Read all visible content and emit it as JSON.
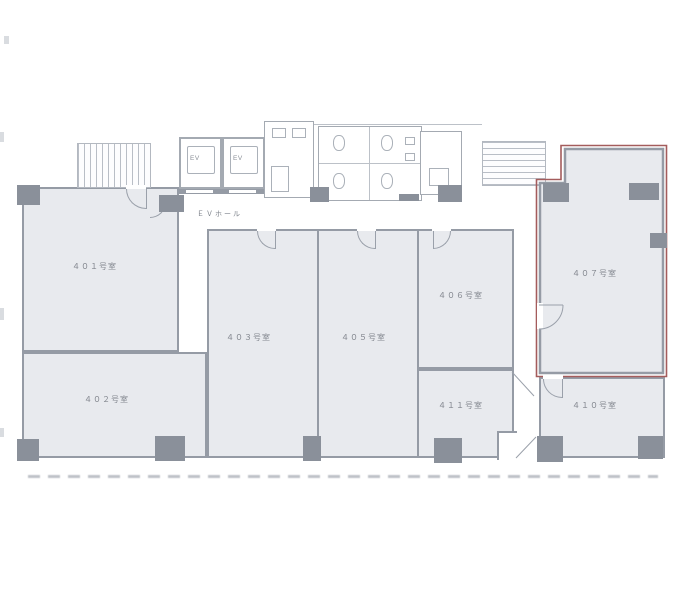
{
  "floor_plan": {
    "ev_hall": {
      "label": "ＥＶホール"
    },
    "elevators": [
      {
        "label": "EV"
      },
      {
        "label": "EV"
      }
    ],
    "rooms": [
      {
        "id": "401",
        "label": "４０１号室",
        "highlighted": false
      },
      {
        "id": "402",
        "label": "４０２号室",
        "highlighted": false
      },
      {
        "id": "403",
        "label": "４０３号室",
        "highlighted": false
      },
      {
        "id": "405",
        "label": "４０５号室",
        "highlighted": false
      },
      {
        "id": "406",
        "label": "４０６号室",
        "highlighted": false
      },
      {
        "id": "407",
        "label": "４０７号室",
        "highlighted": true
      },
      {
        "id": "410",
        "label": "４１０号室",
        "highlighted": false
      },
      {
        "id": "411",
        "label": "４１１号室",
        "highlighted": false
      }
    ],
    "highlighted_room": "407",
    "colors": {
      "room_fill": "#e8eaee",
      "wall": "#959ba5",
      "pillar": "#8a909a",
      "highlight_outline": "#a45c5c",
      "label_text": "#82868e"
    }
  }
}
